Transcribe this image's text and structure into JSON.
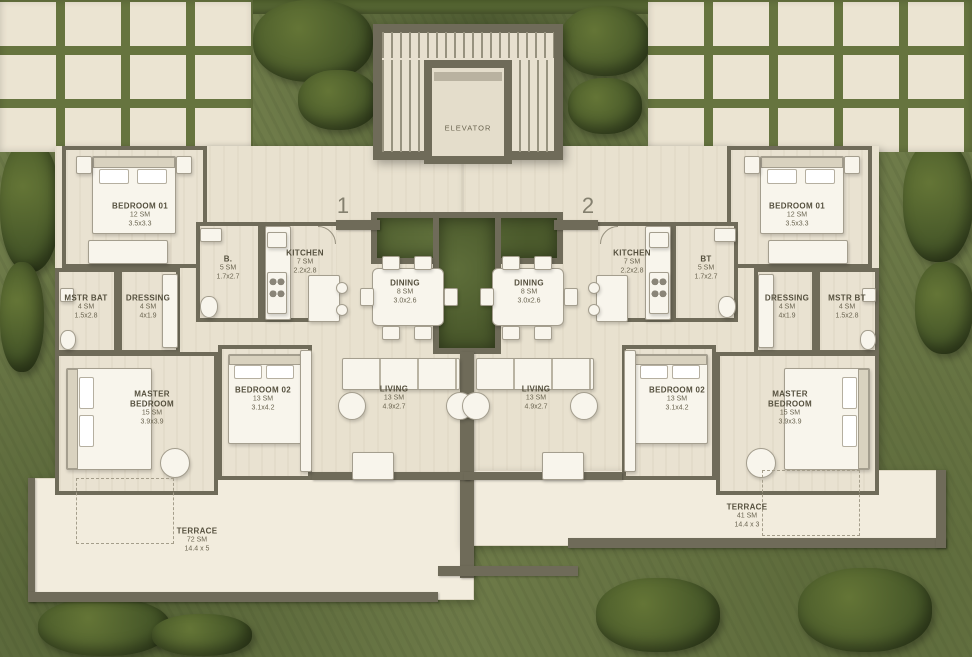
{
  "palette": {
    "grass": "#6e7b49",
    "paving": "#ebe4d2",
    "wall": "#6f6b59",
    "floor": "#e9e2d1",
    "terrace": "#f2ecdd"
  },
  "core": {
    "elevator": "ELEVATOR"
  },
  "units": [
    {
      "number": "1",
      "bedroom01": {
        "name": "BEDROOM 01",
        "area": "12 SM",
        "dims": "3.5x3.3"
      },
      "bath": {
        "name": "B.",
        "area": "5 SM",
        "dims": "1.7x2.7"
      },
      "kitchen": {
        "name": "KITCHEN",
        "area": "7 SM",
        "dims": "2.2x2.8"
      },
      "dining": {
        "name": "DINING",
        "area": "8 SM",
        "dims": "3.0x2.6"
      },
      "master_bath": {
        "name": "MSTR BAT",
        "area": "4 SM",
        "dims": "1.5x2.8"
      },
      "dressing": {
        "name": "DRESSING",
        "area": "4 SM",
        "dims": "4x1.9"
      },
      "master_bedroom": {
        "name": "MASTER BEDROOM",
        "area": "15 SM",
        "dims": "3.9x3.9"
      },
      "bedroom02": {
        "name": "BEDROOM 02",
        "area": "13 SM",
        "dims": "3.1x4.2"
      },
      "living": {
        "name": "LIVING",
        "area": "13 SM",
        "dims": "4.9x2.7"
      },
      "terrace": {
        "name": "TERRACE",
        "area": "72 SM",
        "dims": "14.4 x 5"
      }
    },
    {
      "number": "2",
      "bedroom01": {
        "name": "BEDROOM 01",
        "area": "12 SM",
        "dims": "3.5x3.3"
      },
      "bath": {
        "name": "BT",
        "area": "5 SM",
        "dims": "1.7x2.7"
      },
      "kitchen": {
        "name": "KITCHEN",
        "area": "7 SM",
        "dims": "2.2x2.8"
      },
      "dining": {
        "name": "DINING",
        "area": "8 SM",
        "dims": "3.0x2.6"
      },
      "master_bath": {
        "name": "MSTR BT",
        "area": "4 SM",
        "dims": "1.5x2.8"
      },
      "dressing": {
        "name": "DRESSING",
        "area": "4 SM",
        "dims": "4x1.9"
      },
      "master_bedroom": {
        "name": "MASTER BEDROOM",
        "area": "15 SM",
        "dims": "3.9x3.9"
      },
      "bedroom02": {
        "name": "BEDROOM 02",
        "area": "13 SM",
        "dims": "3.1x4.2"
      },
      "living": {
        "name": "LIVING",
        "area": "13 SM",
        "dims": "4.9x2.7"
      },
      "terrace": {
        "name": "TERRACE",
        "area": "41 SM",
        "dims": "14.4 x 3"
      }
    }
  ]
}
